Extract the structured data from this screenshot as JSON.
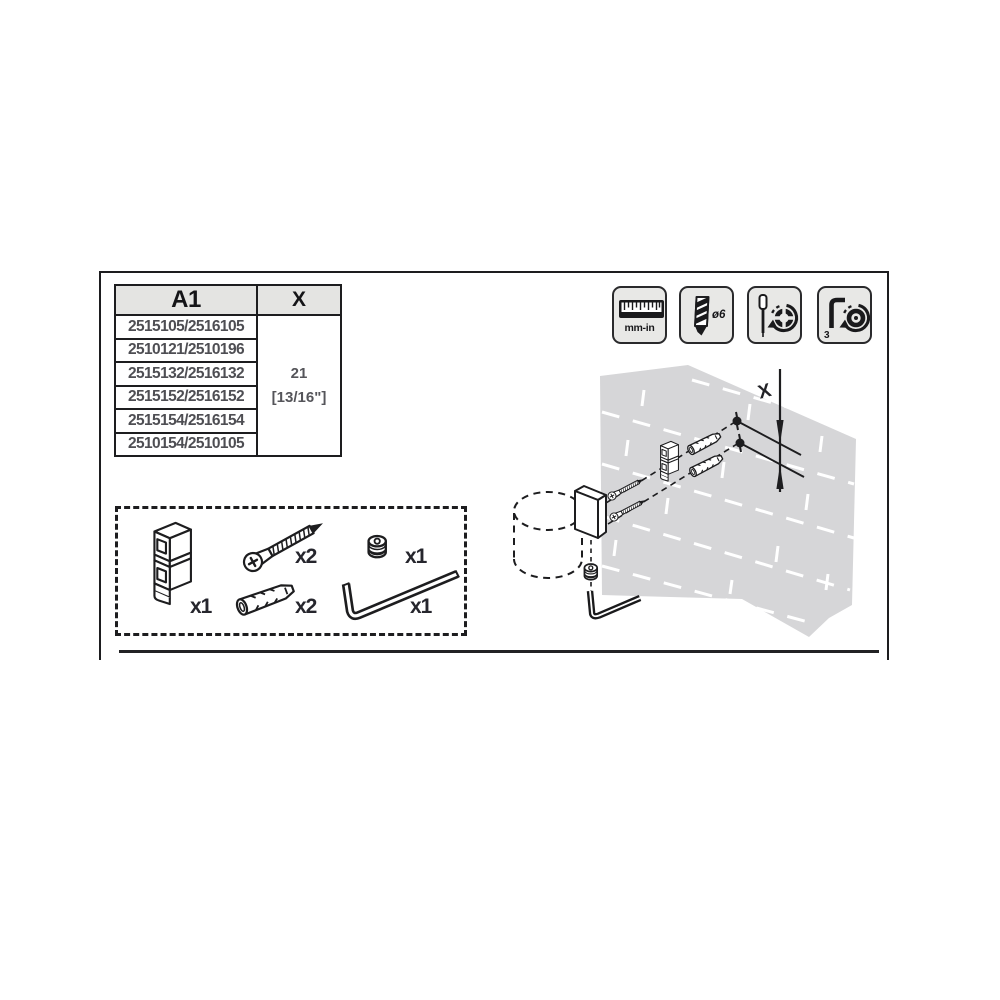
{
  "model_table": {
    "header": {
      "model_col": "A1",
      "dim_col": "X"
    },
    "rows": [
      "2515105/2516105",
      "2510121/2510196",
      "2515132/2516132",
      "2515152/2516152",
      "2515154/2516154",
      "2510154/2510105"
    ],
    "x_value_mm": "21",
    "x_value_in": "[13/16\"]"
  },
  "tools": [
    {
      "icon": "ruler-icon",
      "label": "mm-in"
    },
    {
      "icon": "drill-bit-icon",
      "label": "ø6"
    },
    {
      "icon": "screwdriver-icon",
      "label": ""
    },
    {
      "icon": "allen-key-icon",
      "label": "3"
    }
  ],
  "parts": [
    {
      "name": "wall-bracket",
      "qty": "x1"
    },
    {
      "name": "mounting-screw",
      "qty": "x2"
    },
    {
      "name": "wall-anchor",
      "qty": "x2"
    },
    {
      "name": "set-screw",
      "qty": "x1"
    },
    {
      "name": "allen-key",
      "qty": "x1"
    }
  ],
  "assembly": {
    "dimension_label": "X"
  },
  "colors": {
    "line": "#1d1d1f",
    "wall_gray": "#d6d6d8",
    "icon_bg": "#e8e8e6",
    "table_header_bg": "#e4e4e2",
    "muted_text": "#4e4e53"
  }
}
